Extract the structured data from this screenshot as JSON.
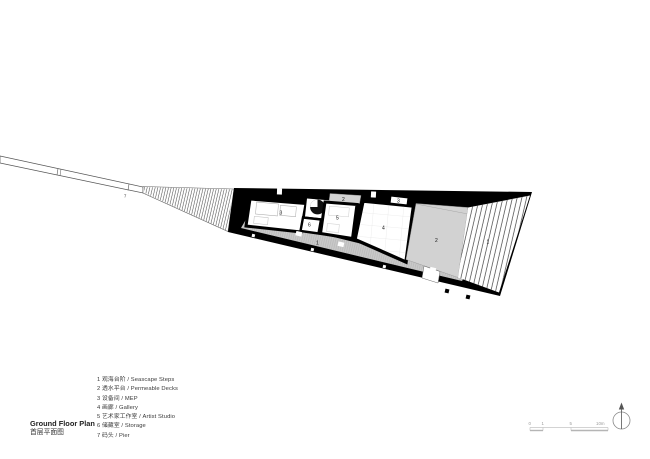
{
  "title": {
    "en": "Ground Floor Plan",
    "zh": "首层平面图"
  },
  "legend": [
    {
      "text": "1 观海台阶 / Seascape Steps"
    },
    {
      "text": "2 透水平台 / Permeable Decks"
    },
    {
      "text": "3 设备间 / MEP"
    },
    {
      "text": "4 画廊 / Gallery"
    },
    {
      "text": "5 艺术家工作室 / Artist Studio"
    },
    {
      "text": "6 储藏室 / Storage"
    },
    {
      "text": "7 码头 / Pier"
    }
  ],
  "plan_labels": {
    "pier": "7",
    "mep": "3",
    "storage": "6",
    "studio": "5",
    "deck_top": "2",
    "gallery": "4",
    "mep_top": "3",
    "deck_right": "2",
    "steps_right": "1",
    "steps_band": "1"
  },
  "scale_bar": {
    "t0": "0",
    "t1": "1",
    "t5": "5",
    "t10": "10m"
  },
  "colors": {
    "wall": "#000000",
    "deck_gray": "#d2d2d2",
    "band_gray": "#c9c9c9",
    "hatch_line": "#3a3a3a"
  }
}
